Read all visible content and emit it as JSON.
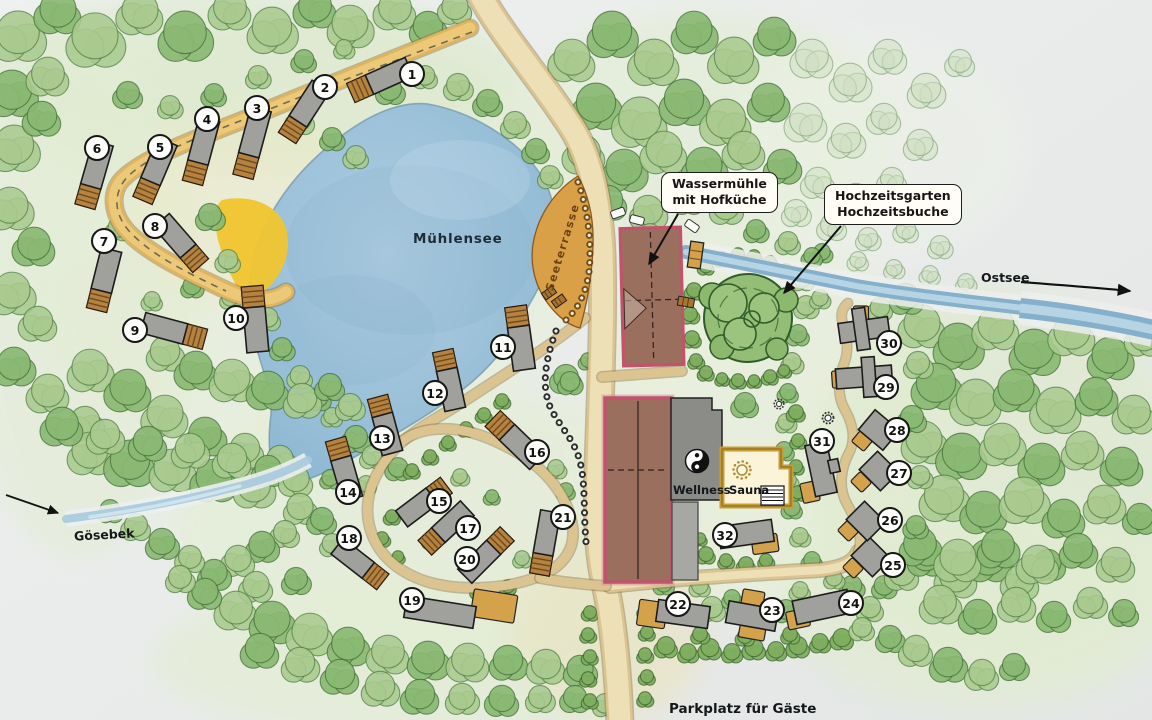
{
  "labels": {
    "lake": "Mühlensee",
    "terrace": "Seeterrasse",
    "mill_line1": "Wassermühle",
    "mill_line2": "mit Hofküche",
    "wedding_line1": "Hochzeitsgarten",
    "wedding_line2": "Hochzeitsbuche",
    "sea": "Ostsee",
    "creek": "Gösebek",
    "wellness": "Wellness",
    "sauna": "Sauna",
    "parking": "Parkplatz für Gäste"
  },
  "markers": [
    {
      "n": 1,
      "x": 412,
      "y": 74
    },
    {
      "n": 2,
      "x": 325,
      "y": 87
    },
    {
      "n": 3,
      "x": 257,
      "y": 108
    },
    {
      "n": 4,
      "x": 207,
      "y": 119
    },
    {
      "n": 5,
      "x": 160,
      "y": 147
    },
    {
      "n": 6,
      "x": 97,
      "y": 148
    },
    {
      "n": 7,
      "x": 104,
      "y": 241
    },
    {
      "n": 8,
      "x": 155,
      "y": 226
    },
    {
      "n": 9,
      "x": 135,
      "y": 330
    },
    {
      "n": 10,
      "x": 236,
      "y": 318
    },
    {
      "n": 11,
      "x": 503,
      "y": 347
    },
    {
      "n": 12,
      "x": 435,
      "y": 393
    },
    {
      "n": 13,
      "x": 382,
      "y": 438
    },
    {
      "n": 14,
      "x": 348,
      "y": 492
    },
    {
      "n": 15,
      "x": 439,
      "y": 501
    },
    {
      "n": 16,
      "x": 537,
      "y": 452
    },
    {
      "n": 17,
      "x": 468,
      "y": 528
    },
    {
      "n": 18,
      "x": 349,
      "y": 538
    },
    {
      "n": 19,
      "x": 412,
      "y": 600
    },
    {
      "n": 20,
      "x": 467,
      "y": 559
    },
    {
      "n": 21,
      "x": 563,
      "y": 517
    },
    {
      "n": 22,
      "x": 678,
      "y": 604
    },
    {
      "n": 23,
      "x": 772,
      "y": 610
    },
    {
      "n": 24,
      "x": 851,
      "y": 603
    },
    {
      "n": 25,
      "x": 893,
      "y": 565
    },
    {
      "n": 26,
      "x": 890,
      "y": 520
    },
    {
      "n": 27,
      "x": 899,
      "y": 473
    },
    {
      "n": 28,
      "x": 897,
      "y": 430
    },
    {
      "n": 29,
      "x": 886,
      "y": 387
    },
    {
      "n": 30,
      "x": 889,
      "y": 343
    },
    {
      "n": 31,
      "x": 822,
      "y": 441
    },
    {
      "n": 32,
      "x": 725,
      "y": 535
    }
  ],
  "colors": {
    "paper": "#eaecec",
    "lake": "#9dc4db",
    "river": "#85b0cc",
    "road": "#dcc491",
    "road_top": "#eee0b6",
    "path_yellow": "#dfb45e",
    "beach": "#f1c52f",
    "terrace": "#d9a047",
    "cabin": "#a0a09c",
    "wood": "#b5823f",
    "mill": "#9b6f5e",
    "mill_border": "#c0546a",
    "tree": "#a9c98e",
    "tree_dark": "#8ab873",
    "annex": "#d3a24b"
  }
}
